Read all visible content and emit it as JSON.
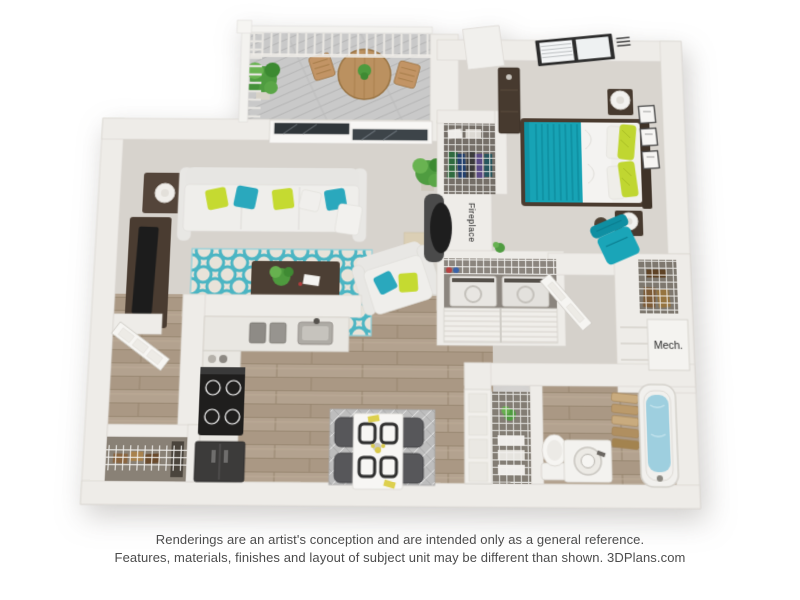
{
  "floorplan": {
    "fireplace_label": "Fireplace",
    "mech_label": "Mech.",
    "colors": {
      "wall": "#eeece8",
      "carpet": "#d7d3cd",
      "wood_floor": "#b1a08d",
      "balcony_deck": "#c9c9c9",
      "accent_teal": "#1aa5b8",
      "accent_green": "#c5da31",
      "rug_base": "#e8e3d9",
      "rug_lattice": "#4bb5c3",
      "dark_wood": "#473a2f",
      "tub_water": "#9ecfdf"
    }
  },
  "disclaimer": {
    "line1": "Renderings are an artist's conception and are intended only as a general reference.",
    "line2": "Features, materials, finishes and layout of subject unit may be different than shown. 3DPlans.com"
  }
}
